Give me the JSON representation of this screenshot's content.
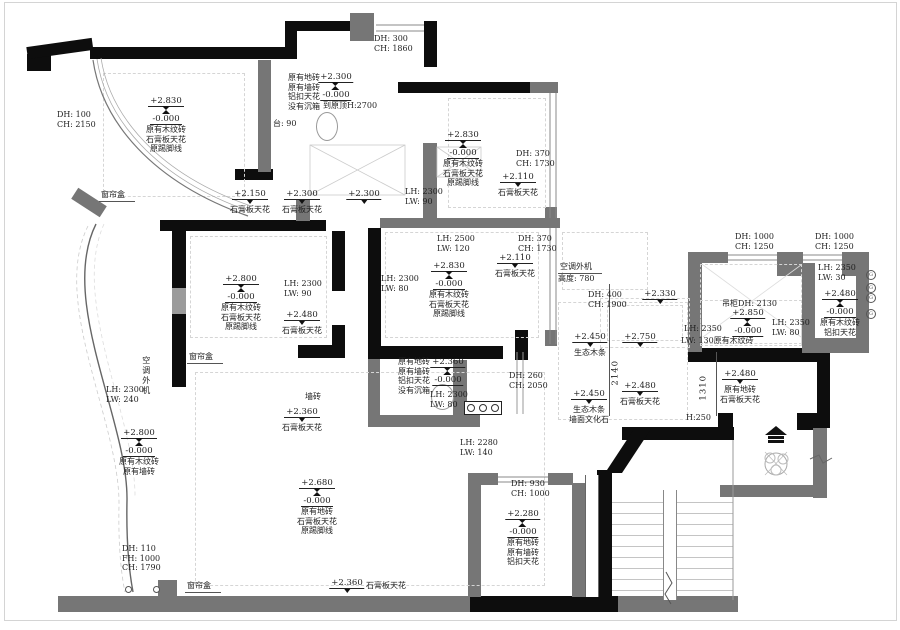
{
  "drawing_title": "ceiling-plan",
  "colors": {
    "wall_black": "#0d0d0d",
    "wall_gray": "#767676",
    "text": "#1f1f1f",
    "dashed": "#d5d5d5"
  },
  "icons": [
    "toilet-icon",
    "entry-arrow-icon",
    "plant-icon",
    "switch-panel-icon",
    "gas-circle-icon",
    "level-mark-icon"
  ],
  "annotations": [
    {
      "id": "dh-top-left",
      "type": "txt",
      "align": "left",
      "x": 57,
      "y": 110,
      "lines": [
        "DH:  100",
        "CH: 2150"
      ]
    },
    {
      "id": "lvl-top-left",
      "type": "lvl2",
      "x": 166,
      "y": 96,
      "v1": "+2.830",
      "v2": "-0.000",
      "lines": [
        "原有木纹砖",
        "石膏板天花",
        "原踢脚线"
      ]
    },
    {
      "id": "curtain-box-1",
      "type": "txt",
      "align": "left",
      "x": 99,
      "y": 190,
      "u": true,
      "lines": [
        "窗帘盒"
      ]
    },
    {
      "id": "bath1-finishes",
      "type": "txt",
      "align": "left",
      "x": 288,
      "y": 73,
      "lines": [
        "原有地砖",
        "原有墙砖",
        "铝扣天花",
        "没有沉箱"
      ]
    },
    {
      "id": "lvl-bath1",
      "type": "lvl2",
      "x": 336,
      "y": 72,
      "v1": "+2.300",
      "v2": "-0.000",
      "lines": []
    },
    {
      "id": "bath1-orig-ceiling",
      "type": "txt",
      "align": "left",
      "x": 323,
      "y": 101,
      "lines": [
        "到原顶H:2700"
      ]
    },
    {
      "id": "bath1-counter",
      "type": "txt",
      "align": "left",
      "x": 273,
      "y": 119,
      "lines": [
        "台: 90"
      ]
    },
    {
      "id": "dh-top-window",
      "type": "txt",
      "align": "left",
      "x": 374,
      "y": 34,
      "lines": [
        "DH:  300",
        "CH: 1860"
      ]
    },
    {
      "id": "lvl-2150",
      "type": "lvl1",
      "x": 250,
      "y": 189,
      "v1": "+2.150",
      "lines": [
        "石膏板天花"
      ]
    },
    {
      "id": "lvl-2300-a",
      "type": "lvl1",
      "x": 302,
      "y": 189,
      "v1": "+2.300",
      "lines": [
        "石膏板天花"
      ]
    },
    {
      "id": "lvl-2300-b",
      "type": "lvl1",
      "x": 364,
      "y": 189,
      "v1": "+2.300",
      "lines": []
    },
    {
      "id": "lvl-bed2",
      "type": "lvl2",
      "x": 463,
      "y": 130,
      "v1": "+2.830",
      "v2": "-0.000",
      "lines": [
        "原有木纹砖",
        "石膏板天花",
        "原踢脚线"
      ]
    },
    {
      "id": "dh-bed2",
      "type": "txt",
      "align": "left",
      "x": 516,
      "y": 149,
      "lines": [
        "DH:  370",
        "CH: 1730"
      ]
    },
    {
      "id": "lvl-2110-a",
      "type": "lvl1",
      "x": 518,
      "y": 172,
      "v1": "+2.110",
      "lines": [
        "石膏板天花"
      ]
    },
    {
      "id": "lh-bed2",
      "type": "txt",
      "align": "left",
      "x": 405,
      "y": 187,
      "lines": [
        "LH: 2300",
        "LW:   90"
      ]
    },
    {
      "id": "lh-master-top",
      "type": "txt",
      "align": "left",
      "x": 437,
      "y": 234,
      "lines": [
        "LH: 2500",
        "LW:  120"
      ]
    },
    {
      "id": "dh-master",
      "type": "txt",
      "align": "left",
      "x": 518,
      "y": 234,
      "lines": [
        "DH:  370",
        "CH: 1730"
      ]
    },
    {
      "id": "lvl-2110-b",
      "type": "lvl1",
      "x": 515,
      "y": 253,
      "v1": "+2.110",
      "lines": [
        "石膏板天花"
      ]
    },
    {
      "id": "lvl-master",
      "type": "lvl2",
      "x": 449,
      "y": 261,
      "v1": "+2.830",
      "v2": "-0.000",
      "lines": [
        "原有木纹砖",
        "石膏板天花",
        "原踢脚线"
      ]
    },
    {
      "id": "lh-master-left",
      "type": "txt",
      "align": "left",
      "x": 381,
      "y": 274,
      "lines": [
        "LH: 2300",
        "LW:   80"
      ]
    },
    {
      "id": "ac-unit-right",
      "type": "txt",
      "align": "left",
      "x": 558,
      "y": 262,
      "u": true,
      "lines": [
        "空调外机",
        "高度: 780"
      ]
    },
    {
      "id": "dh-balcony",
      "type": "txt",
      "align": "left",
      "x": 588,
      "y": 290,
      "lines": [
        "DH:  400",
        "CH: 1900"
      ]
    },
    {
      "id": "lvl-2330",
      "type": "lvl1",
      "x": 660,
      "y": 289,
      "v1": "+2.330",
      "lines": []
    },
    {
      "id": "dh-kitchen-win1",
      "type": "txt",
      "align": "left",
      "x": 735,
      "y": 232,
      "lines": [
        "DH: 1000",
        "CH: 1250"
      ]
    },
    {
      "id": "dh-kitchen-win2",
      "type": "txt",
      "align": "left",
      "x": 815,
      "y": 232,
      "lines": [
        "DH: 1000",
        "CH: 1250"
      ]
    },
    {
      "id": "cabinet-height",
      "type": "txt",
      "align": "left",
      "x": 722,
      "y": 299,
      "lines": [
        "吊柜DH: 2130"
      ]
    },
    {
      "id": "lvl-kitchen",
      "type": "lvl2",
      "x": 748,
      "y": 308,
      "v1": "+2.850",
      "v2": "-0.000",
      "lines": []
    },
    {
      "id": "lh-kitchen-1",
      "type": "txt",
      "align": "left",
      "x": 684,
      "y": 324,
      "lines": [
        "LH: 2350"
      ]
    },
    {
      "id": "lw-kitchen-1",
      "type": "txt",
      "align": "left",
      "x": 681,
      "y": 336,
      "lines": [
        "LW: 130原有木纹砖"
      ]
    },
    {
      "id": "lh-kitchen-2",
      "type": "txt",
      "align": "left",
      "x": 772,
      "y": 318,
      "lines": [
        "LH: 2350",
        "LW:   80"
      ]
    },
    {
      "id": "lh-pantry",
      "type": "txt",
      "align": "left",
      "x": 818,
      "y": 263,
      "lines": [
        "LH: 2350",
        "LW:   30"
      ]
    },
    {
      "id": "lvl-pantry",
      "type": "lvl2",
      "x": 840,
      "y": 289,
      "v1": "+2.480",
      "v2": "-0.000",
      "lines": [
        "原有木纹砖",
        "铝扣天花"
      ]
    },
    {
      "id": "lvl-2450-a",
      "type": "lvl1",
      "x": 590,
      "y": 332,
      "v1": "+2.450",
      "lines": [
        "生态木条"
      ]
    },
    {
      "id": "lvl-2750",
      "type": "lvl1",
      "x": 640,
      "y": 332,
      "v1": "+2.750",
      "lines": []
    },
    {
      "id": "dim-2140",
      "type": "vtxt",
      "x": 616,
      "y": 367,
      "v1": "2140"
    },
    {
      "id": "lvl-2480-dining",
      "type": "lvl1",
      "x": 640,
      "y": 381,
      "v1": "+2.480",
      "lines": [
        "石膏板天花"
      ]
    },
    {
      "id": "lvl-2450-b",
      "type": "lvl1",
      "x": 589,
      "y": 389,
      "v1": "+2.450",
      "lines": [
        "生态木条",
        "墙面文化石"
      ]
    },
    {
      "id": "dim-1310",
      "type": "vtxt",
      "x": 704,
      "y": 382,
      "v1": "1310"
    },
    {
      "id": "lvl-2480-hall",
      "type": "lvl1",
      "x": 740,
      "y": 369,
      "v1": "+2.480",
      "lines": [
        "原有地砖",
        "石膏板天花"
      ]
    },
    {
      "id": "h250-wall",
      "type": "txt",
      "align": "left",
      "x": 686,
      "y": 413,
      "lines": [
        "H:250"
      ]
    },
    {
      "id": "lh-living-edge",
      "type": "txt",
      "align": "left",
      "x": 460,
      "y": 438,
      "lines": [
        "LH: 2280",
        "LW:  140"
      ]
    },
    {
      "id": "bath2-finishes",
      "type": "txt",
      "align": "left",
      "x": 398,
      "y": 357,
      "lines": [
        "原有地砖",
        "原有墙砖",
        "铝扣天花",
        "没有沉箱"
      ]
    },
    {
      "id": "lvl-bath2",
      "type": "lvl2",
      "x": 448,
      "y": 357,
      "v1": "+2.360",
      "v2": "-0.000",
      "lines": []
    },
    {
      "id": "lh-bath2",
      "type": "txt",
      "align": "left",
      "x": 430,
      "y": 390,
      "lines": [
        "LH: 2300",
        "LW:   80"
      ]
    },
    {
      "id": "dh-bath2",
      "type": "txt",
      "align": "left",
      "x": 509,
      "y": 371,
      "lines": [
        "DH:  260",
        "CH: 2050"
      ]
    },
    {
      "id": "wall-tile-note",
      "type": "txt",
      "align": "left",
      "x": 305,
      "y": 392,
      "lines": [
        "墙砖"
      ]
    },
    {
      "id": "lvl-2360-living-top",
      "type": "lvl1",
      "x": 302,
      "y": 407,
      "v1": "+2.360",
      "lines": [
        "石膏板天花"
      ]
    },
    {
      "id": "lvl-left-balcony",
      "type": "lvl2",
      "x": 139,
      "y": 428,
      "v1": "+2.800",
      "v2": "-0.000",
      "lines": [
        "原有木纹砖",
        "原有墙砖"
      ]
    },
    {
      "id": "dh-left-bottom",
      "type": "txt",
      "align": "left",
      "x": 122,
      "y": 544,
      "lines": [
        "DH:  110",
        "FH: 1000",
        "CH: 1790"
      ]
    },
    {
      "id": "curtain-box-2",
      "type": "txt",
      "align": "left",
      "x": 185,
      "y": 581,
      "u": true,
      "lines": [
        "窗帘盒"
      ]
    },
    {
      "id": "curtain-box-3",
      "type": "txt",
      "align": "left",
      "x": 187,
      "y": 352,
      "u": true,
      "lines": [
        "窗帘盒"
      ]
    },
    {
      "id": "lvl-bed1",
      "type": "lvl2",
      "x": 241,
      "y": 274,
      "v1": "+2.800",
      "v2": "-0.000",
      "lines": [
        "原有木纹砖",
        "石膏板天花",
        "原踢脚线"
      ]
    },
    {
      "id": "lh-bed1",
      "type": "txt",
      "align": "left",
      "x": 284,
      "y": 279,
      "lines": [
        "LH: 2300",
        "LW:   90"
      ]
    },
    {
      "id": "lvl-2480-bed1",
      "type": "lvl1",
      "x": 302,
      "y": 310,
      "v1": "+2.480",
      "lines": [
        "石膏板天花"
      ]
    },
    {
      "id": "lh-left-balcony",
      "type": "txt",
      "align": "left",
      "x": 106,
      "y": 385,
      "lines": [
        "LH: 2300",
        "LW:  240"
      ]
    },
    {
      "id": "ac-unit-left",
      "type": "vtxt",
      "cjk": true,
      "x": 146,
      "y": 356,
      "v1": "空调外机"
    },
    {
      "id": "lvl-living",
      "type": "lvl2",
      "x": 317,
      "y": 478,
      "v1": "+2.680",
      "v2": "-0.000",
      "lines": [
        "原有地砖",
        "石膏板天花",
        "原踢脚线"
      ]
    },
    {
      "id": "lvl-2360-living-bottom",
      "type": "lvl1",
      "x": 347,
      "y": 578,
      "v1": "+2.360",
      "lines": []
    },
    {
      "id": "living-bottom-ceiling",
      "type": "txt",
      "align": "left",
      "x": 366,
      "y": 581,
      "lines": [
        "石膏板天花"
      ]
    },
    {
      "id": "dh-laundry",
      "type": "txt",
      "align": "left",
      "x": 511,
      "y": 479,
      "lines": [
        "DH:  930",
        "CH: 1000"
      ]
    },
    {
      "id": "lvl-laundry",
      "type": "lvl2",
      "x": 523,
      "y": 509,
      "v1": "+2.280",
      "v2": "-0.000",
      "lines": [
        "原有地砖",
        "原有墙砖",
        "铝扣天花"
      ]
    }
  ]
}
